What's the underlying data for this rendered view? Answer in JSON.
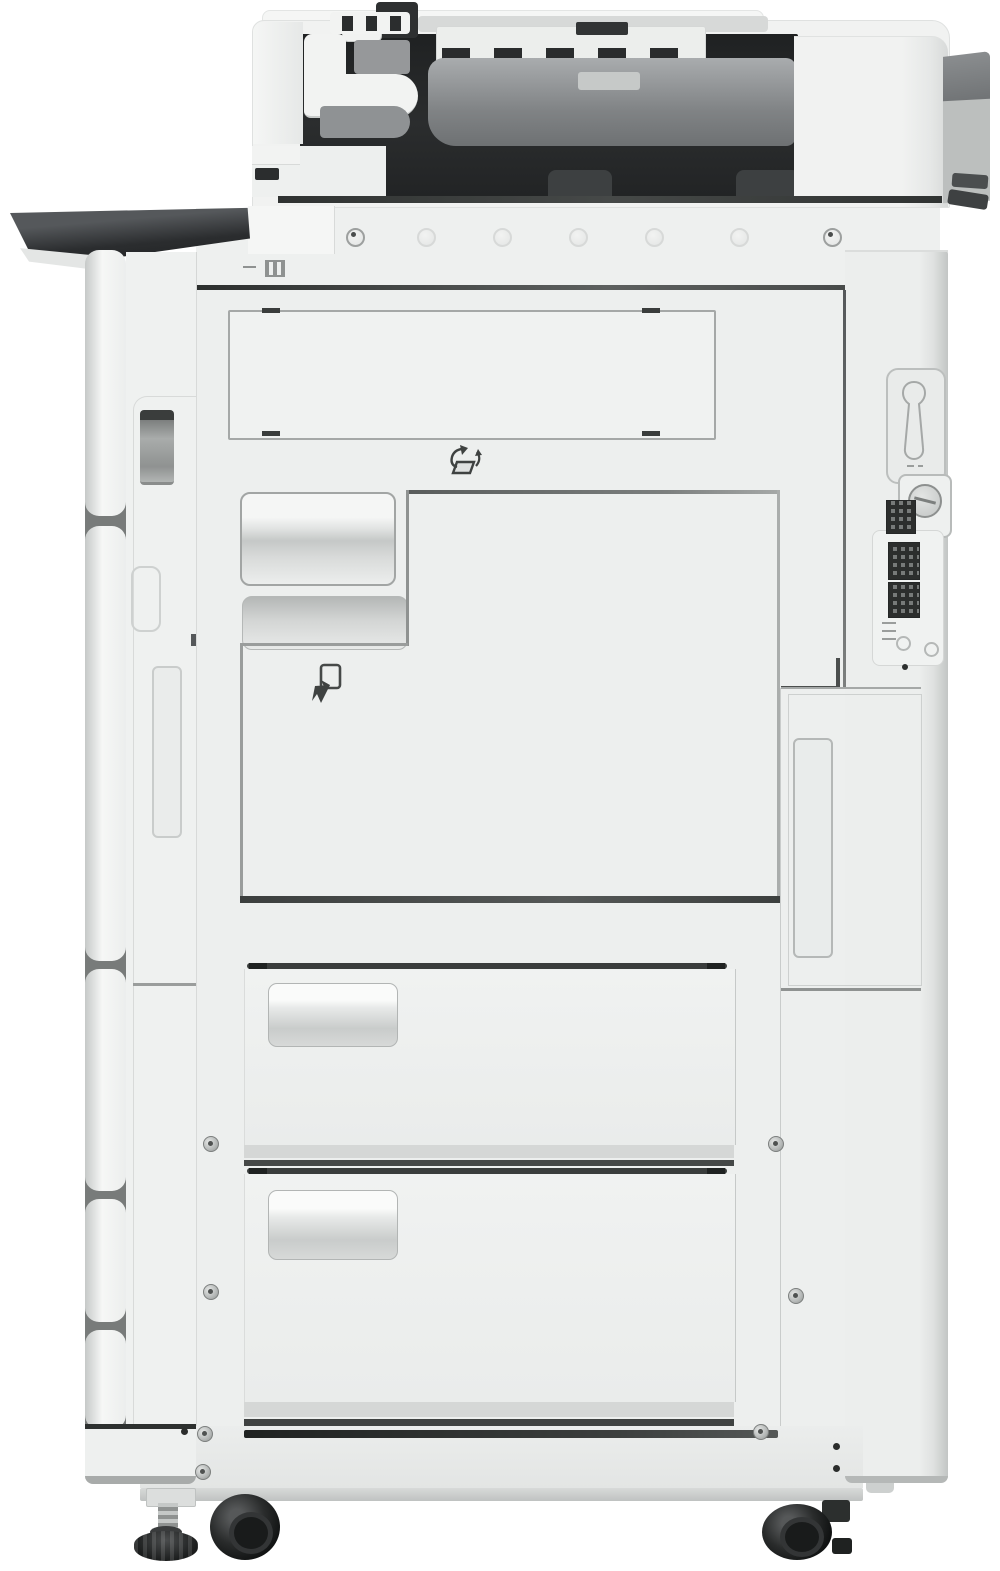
{
  "device": {
    "kind": "office multifunction printer, front product photo",
    "visible_text": "none",
    "top_screw_circles": 7,
    "paper_drawers": 2,
    "casters": 2,
    "leveling_feet": 1
  },
  "parts": {
    "adf": "Automatic document feeder",
    "adf_cavity": "Document feeder opening",
    "adf_roller": "Feeder roller cover",
    "hinge": "Feeder hinge",
    "side_shelf": "Left side shelf (dark top)",
    "screw_strip": "Upper fastener strip",
    "upper_panel": "Upper access panel outline",
    "front_door": "Front main door",
    "toner_handle": "Recessed toner door handle",
    "lower_notch": "Lower recessed grip",
    "left_tower": "Left side trim tower",
    "nameplate": "Vertical nameplate badge",
    "right_column": "Right side column",
    "keyhole_panel": "Security slot panel",
    "lock_screw": "Round lock fastener",
    "labels": "Serial / QR labels",
    "tray1": "Paper drawer 1",
    "tray2": "Paper drawer 2",
    "base": "Base plinth",
    "left_foot": "Adjustable leveling foot",
    "caster_left": "Left caster wheel",
    "caster_right": "Right caster wheel"
  },
  "icons": {
    "open_feed_icon": "curved-arrow open-cover pictogram",
    "pull_out_icon": "pull-out door pictogram",
    "key_slot_icon": "key slot outline",
    "paper_load_marks": "small paper-load marking",
    "latch_mark": "small latch marking"
  },
  "colors": {
    "bg": "#ffffff",
    "bodyLight": "#f1f2f1",
    "body": "#edefee",
    "bodyDim": "#e8eae9",
    "edge": "#c8cbca",
    "lineMid": "#9da09f",
    "seamDark": "#3a3d3c",
    "cavity": "#2b2d2e",
    "roller": "#85888a",
    "shelfDark": "#2f3233",
    "caster": "#171919"
  }
}
